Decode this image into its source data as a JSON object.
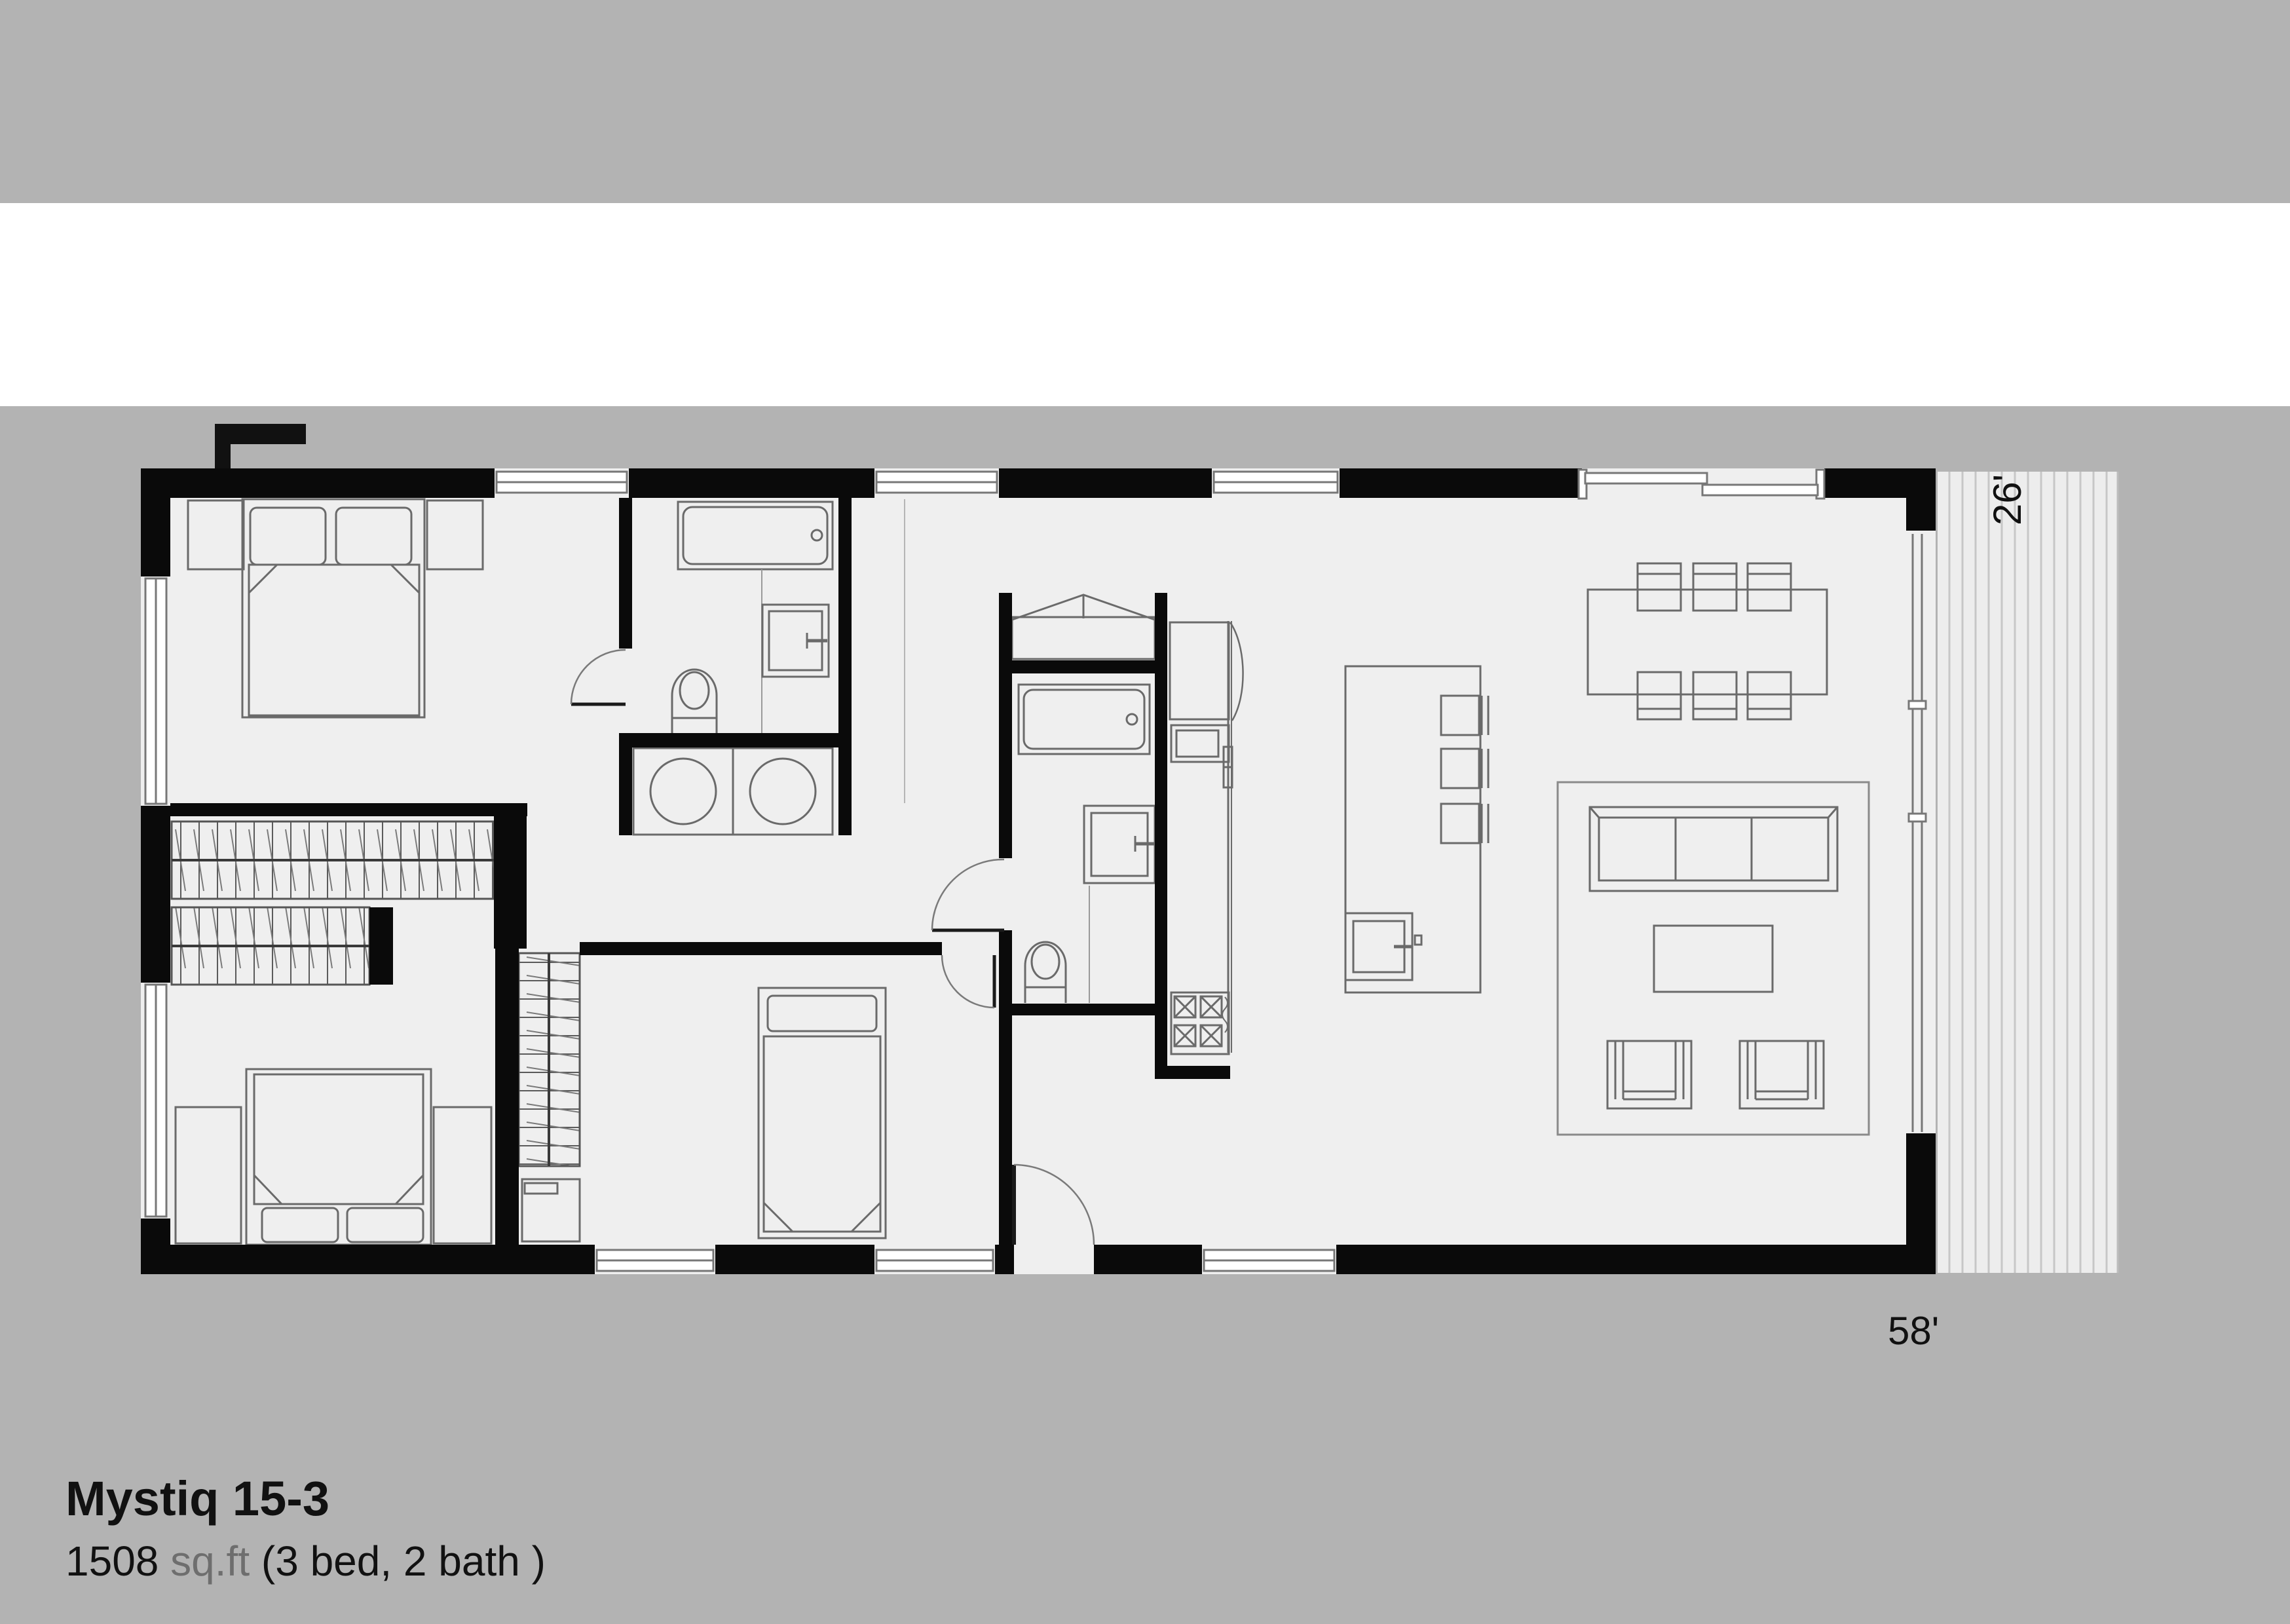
{
  "header": {
    "logo_text": "mantle",
    "brand_accent_color": "#c49a6c"
  },
  "floor_plan": {
    "name": "Mystiq 15-3",
    "area_value": "1508",
    "area_unit": "sq.ft",
    "rooms_text": "(3 bed, 2 bath )",
    "width_label": "58'",
    "depth_label": "26'"
  },
  "colors": {
    "page_background": "#b3b3b3",
    "header_band": "#ffffff",
    "floor_fill": "#efefef",
    "deck_fill": "#ededed",
    "wall_fill": "#0a0a0a",
    "furniture_stroke": "#6a6a6a",
    "accent": "#c49a6c"
  }
}
